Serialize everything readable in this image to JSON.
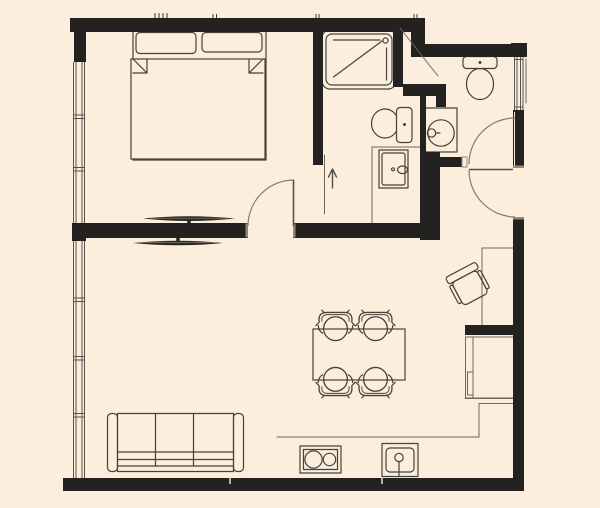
{
  "canvas": {
    "width": 600,
    "height": 508
  },
  "palette": {
    "background": "#FBEEDD",
    "wall": "#232220",
    "furniture_line": "#46423B",
    "dark_fill": "#2A2925",
    "thin_line": "#6E685C",
    "arc_line": "#837D6F",
    "window_line": "#57534B",
    "cap_highlight": "#8F8979"
  },
  "fixtures": {
    "bedroom": [
      "double-bed",
      "pillow-left",
      "pillow-right",
      "duvet",
      "wall-tv"
    ],
    "living_room": [
      "three-seat-sofa",
      "wall-tv",
      "dining-table",
      "dining-chair x4"
    ],
    "kitchen": [
      "l-counter",
      "cooktop-2-burner",
      "kitchen-sink",
      "tall-cabinet"
    ],
    "main_bathroom": [
      "shower-tray",
      "toilet",
      "washing-machine",
      "sliding-door",
      "direction-arrow"
    ],
    "second_bathroom": [
      "toilet",
      "washbasin-vanity",
      "swing-door"
    ],
    "entry_area": [
      "entry-door",
      "desk",
      "desk-chair",
      "shaft-diagonal"
    ],
    "windows": [
      "left-window-upper",
      "left-window-lower",
      "bathroom-window-right"
    ],
    "doors": [
      "bedroom-door",
      "bathroom-door",
      "entry-door"
    ]
  }
}
